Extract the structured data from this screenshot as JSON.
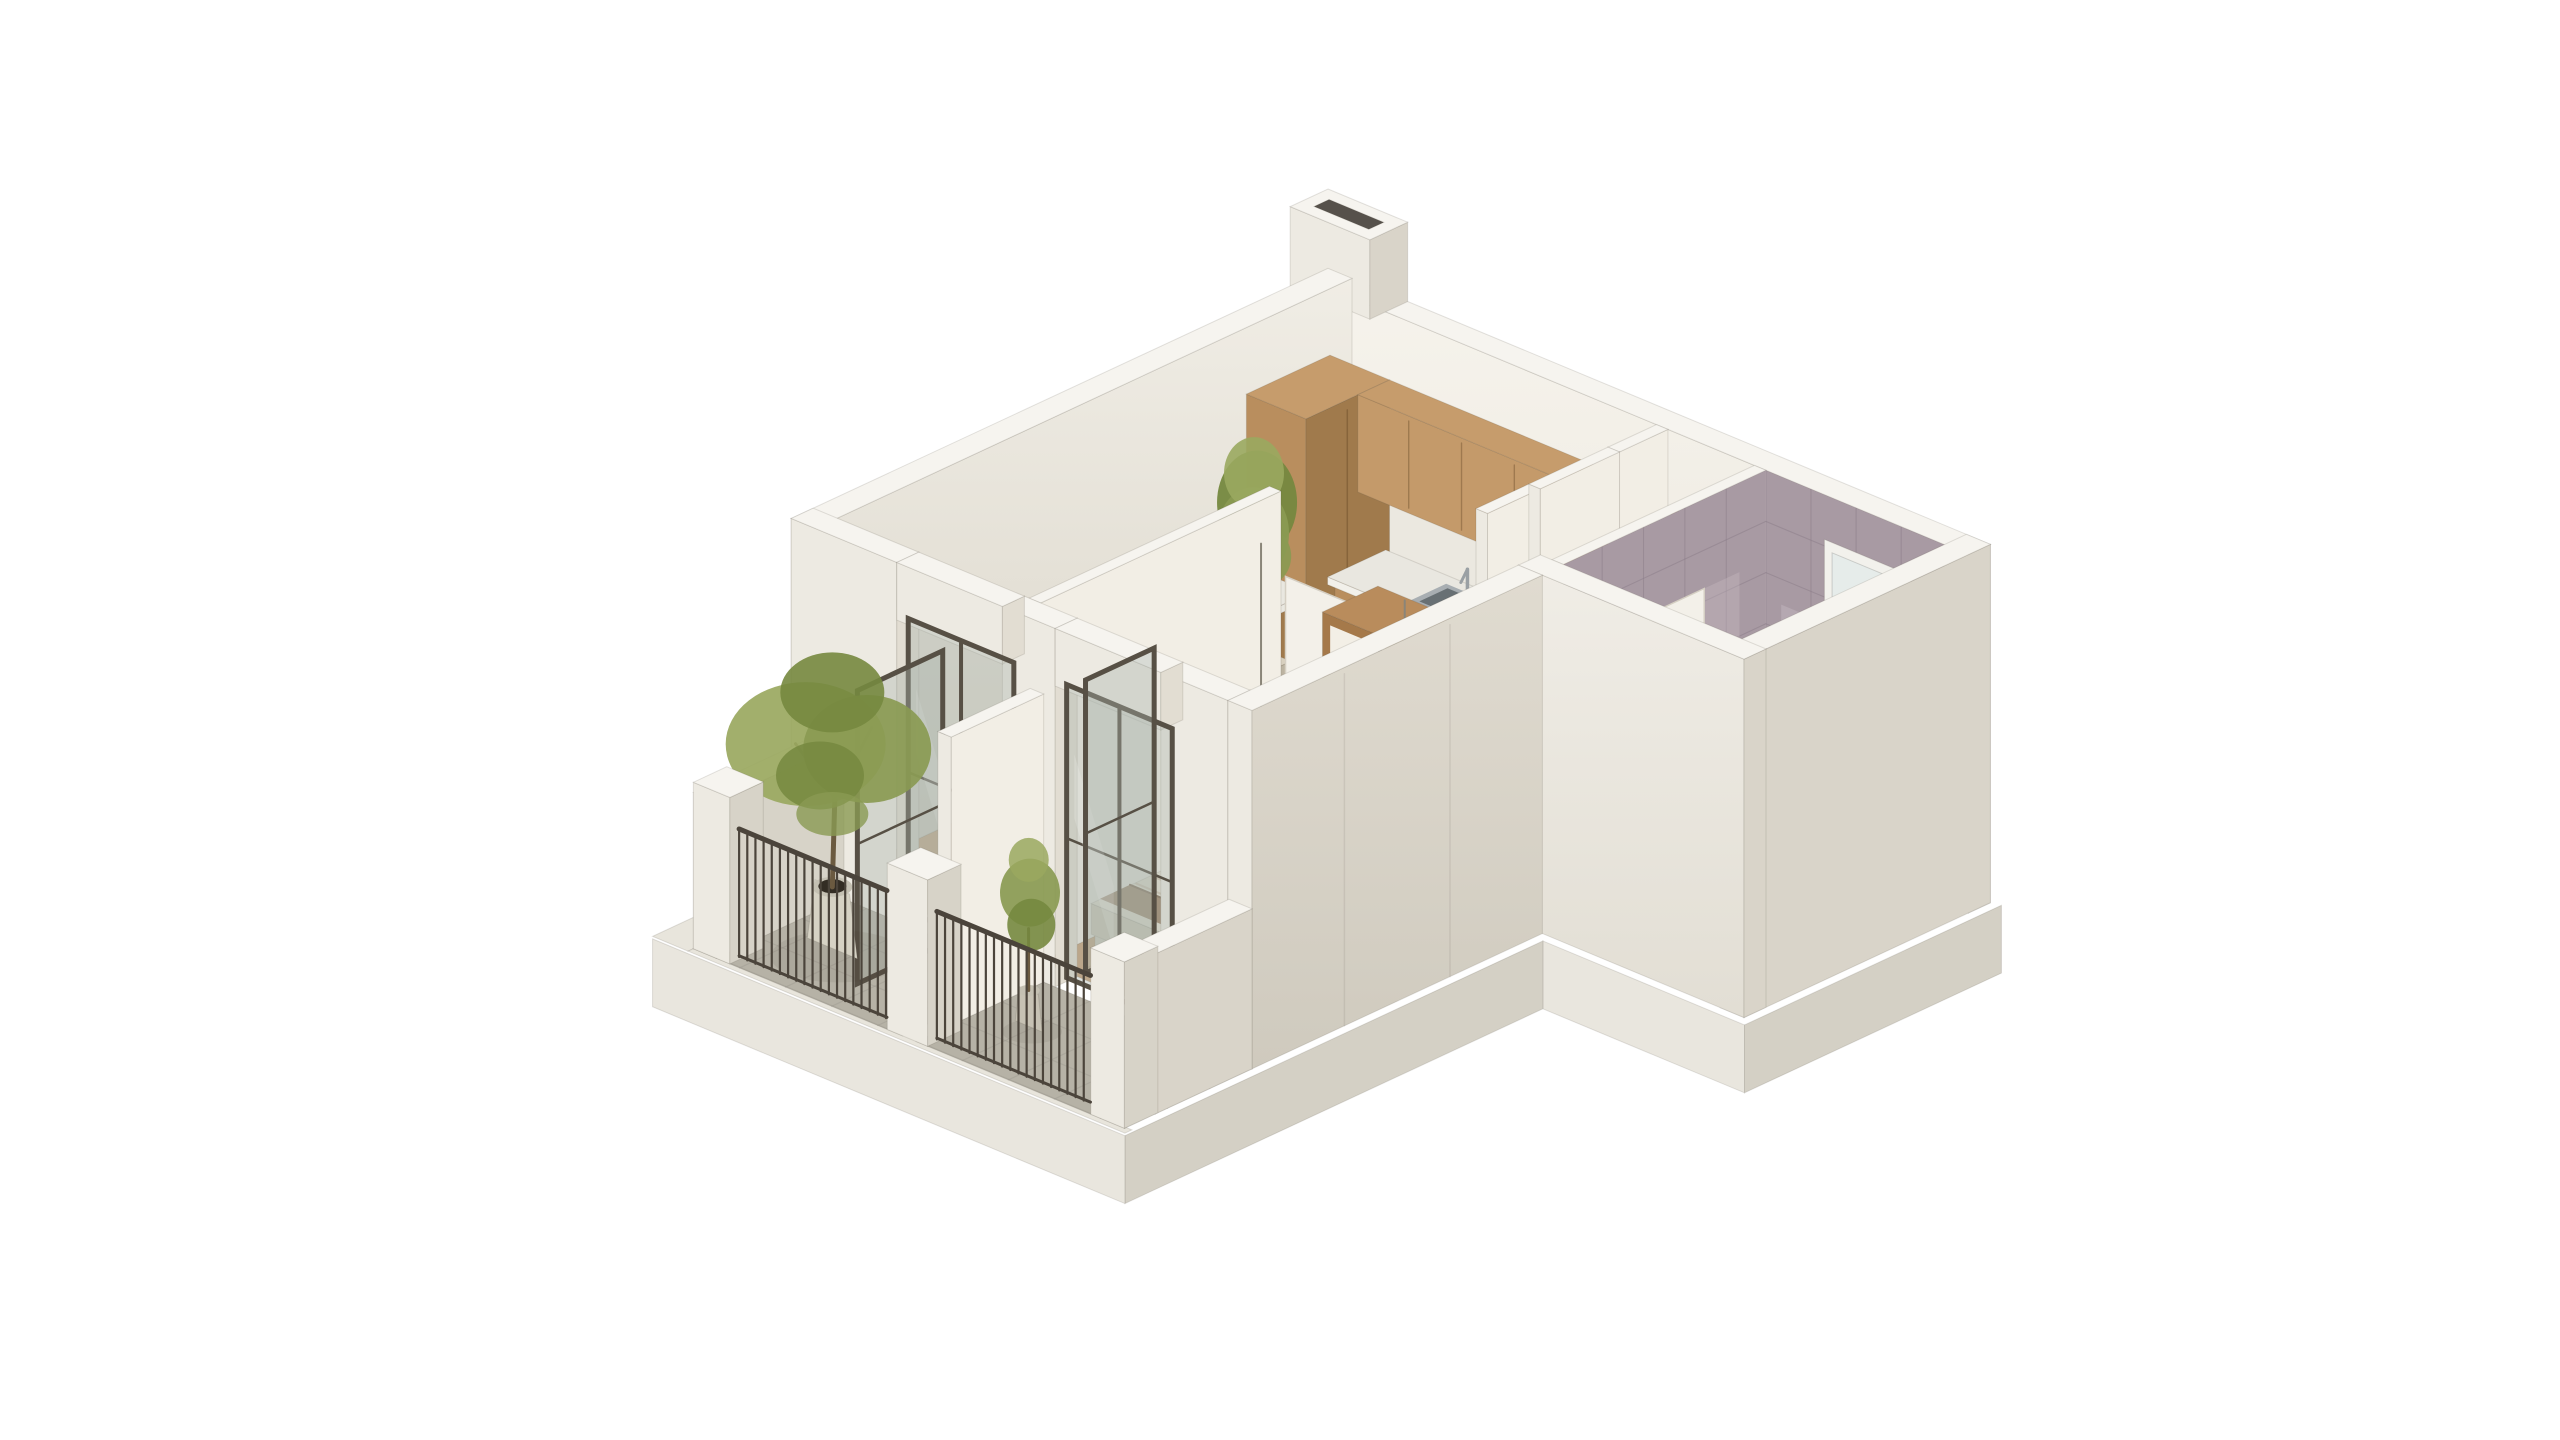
{
  "scene": {
    "type": "isometric-apartment-floorplan-3d-render",
    "background": "#ffffff",
    "rooms": [
      {
        "name": "living-room-with-open-kitchen"
      },
      {
        "name": "bedroom"
      },
      {
        "name": "bathroom"
      },
      {
        "name": "hallway"
      },
      {
        "name": "living-room-balcony"
      },
      {
        "name": "bedroom-balcony"
      }
    ],
    "items": [
      {
        "id": "plinth",
        "label": "building-base"
      },
      {
        "id": "floor_living",
        "label": "living-kitchen-hall-wood-floor"
      },
      {
        "id": "floor_bedroom",
        "label": "bedroom-wood-floor"
      },
      {
        "id": "floor_bath",
        "label": "bathroom-tile-floor"
      },
      {
        "id": "floor_balcony",
        "label": "balcony-stone-floors"
      },
      {
        "id": "wall_top_right",
        "label": "north-east-wall-entrance-window-chimney"
      },
      {
        "id": "wall_left",
        "label": "north-west-wall"
      },
      {
        "id": "kitchen",
        "label": "kitchen-cabinets-counter-sink-cooktop"
      },
      {
        "id": "plant_living",
        "label": "indoor-potted-plant"
      },
      {
        "id": "sofa",
        "label": "corner-sofa-with-cushions"
      },
      {
        "id": "hall_wall",
        "label": "hallway-partition-and-open-door"
      },
      {
        "id": "bath_divider",
        "label": "bathroom-marble-partition-wall"
      },
      {
        "id": "bath_fixtures",
        "label": "bathroom-vanity-shower-mirror"
      },
      {
        "id": "wall_right",
        "label": "east-outer-wall"
      },
      {
        "id": "wall_bath_bottom",
        "label": "bathroom-south-wall"
      },
      {
        "id": "rug",
        "label": "purple-area-rug"
      },
      {
        "id": "coffee_table",
        "label": "marble-coffee-table"
      },
      {
        "id": "wall_divider",
        "label": "living-bedroom-divider-wall"
      },
      {
        "id": "bedroom_door",
        "label": "bedroom-interior-door"
      },
      {
        "id": "wardrobe",
        "label": "bedroom-wardrobe"
      },
      {
        "id": "bed",
        "label": "double-bed-with-pillows"
      },
      {
        "id": "pendants",
        "label": "bedside-pendant-lamps"
      },
      {
        "id": "wall_bottom",
        "label": "south-west-wall-and-glass-balcony-doors"
      },
      {
        "id": "wall_bedroom_right",
        "label": "bedroom-outer-wall"
      },
      {
        "id": "balcony_structures",
        "label": "balcony-parapet-walls"
      },
      {
        "id": "balcony_plants",
        "label": "balcony-trees-in-pots"
      },
      {
        "id": "railings",
        "label": "balcony-metal-railings-and-pillars"
      }
    ]
  },
  "palette": {
    "bg": "#ffffff",
    "wallTop": "#f6f4ef",
    "wallInnerU_a": "#f0ede5",
    "wallInnerU_b": "#d9d4c8",
    "wallInnerV_a": "#f6f3ec",
    "wallInnerV_b": "#e9e5db",
    "wallOuterU": "#d9d4c9",
    "wallOuterU_b": "#cfcabe",
    "wallOuterV": "#edeae2",
    "wallBright": "#f2eee5",
    "wallEnd": "#e2ddd2",
    "plinthU": "#d4d0c5",
    "plinthV": "#e9e6de",
    "ledge": "#e8e5dc",
    "floorWood": "#cda57e",
    "floorWoodLine": "#a97f55",
    "floorBedroom": "#c79f77",
    "bathFloor": "#87a5a2",
    "bathFloorLine": "#6e918e",
    "marble": "#a89aa3",
    "marbleLine": "#8b7d89",
    "marbleLight": "#cfc3cb",
    "balconyFloor": "#b6b2a6",
    "balconyLine": "#97938a",
    "cabWood": "#b98e5e",
    "cabWoodDark": "#a07a4c",
    "cabWoodTop": "#c69c6c",
    "cabWoodLight": "#c49a6a",
    "cabGap": "rgba(90,60,30,0.35)",
    "counter": "#e9e7e0",
    "counterEdge": "#f2f0ea",
    "backsplash": "#ebe8e0",
    "sinkSteel": "#a8aeb2",
    "sinkDark": "#687074",
    "cooktop": "#1d1d1b",
    "burner": "#3d3d3b",
    "board": "#b3854f",
    "doorDark": "#3a332b",
    "doorRecess": "#2e2923",
    "doorFrameWood": "#a8835c",
    "doorWhite": "#f3f0e9",
    "doorLine": "#d5cfc3",
    "doorSlit": "#47403a",
    "handleTeal": "#3f7d74",
    "glassFill": "rgba(168,178,172,0.38)",
    "glassSheen": "rgba(255,255,255,0.18)",
    "frameBronze": "#575045",
    "sofaBase": "#cec6b4",
    "sofaSide": "#bcb3a1",
    "sofaTop": "#d8d0bf",
    "cushBrown1": "#8d7c6a",
    "cushBrown2": "#75644f",
    "cushBrown3": "#5a4938",
    "cushPurple": "#533f80",
    "cushPurple2": "#6a55a0",
    "rug": "#3b2f68",
    "rugLight": "#5a4a8e",
    "tableTop": "#ecE9e2",
    "tableSide": "#e0dcd3",
    "vein": "#c9c4ba",
    "bedBase": "#d9d1c1",
    "duvet": "#e8e2d4",
    "duvetStripe": "#c3ad93",
    "duvetSide": "#d3cbba",
    "blanket": "#96775c",
    "pillowPurple": "#8b74b2",
    "pillowPurpleD": "#6f598e",
    "pillowWhite": "#f0ebe2",
    "headboard": "#e2dbcb",
    "wardWood": "#a5794a",
    "wardWoodD": "#8f6136",
    "wardWoodTop": "#b98c5c",
    "wardDoor": "#f3efe6",
    "potWhite": "#d6d2c4",
    "potSide": "#c4c0b2",
    "soil": "#332d24",
    "leaf1": "#8a9a52",
    "leaf2": "#75883f",
    "leaf3": "#9aa85f",
    "trunk": "#6b5a40",
    "railing": "#4b443b",
    "steel": "#b4b0a6",
    "cord": "#8a8578",
    "shadow": "rgba(60,50,40,0.08)",
    "glassShower": "rgba(188,208,210,0.42)",
    "fixtureWhite": "#f0f2f1",
    "vanityTeal": "#8fa9a8",
    "windowGlass": "#e6ecea",
    "mirror": "#4a4642"
  }
}
